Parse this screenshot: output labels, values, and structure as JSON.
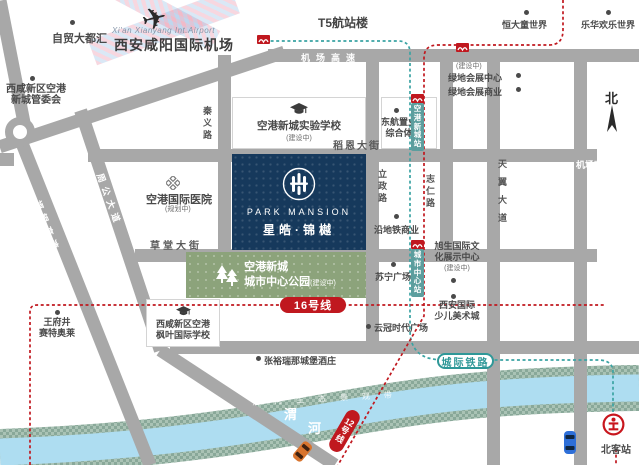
{
  "airport": {
    "cn": "西安咸阳国际机场",
    "en": "Xi'an Xianyang Int.Airport",
    "t5": "T5航站楼"
  },
  "compass": "北",
  "project": {
    "brand": "PARK MANSION",
    "name": "星皓·锦樾"
  },
  "roads": {
    "jichang_h": "机场高速",
    "jichang_v": "机场高速",
    "qinyi": "秦义路",
    "zhougong": "周公大道",
    "fuyin": "福银高速",
    "caotang": "草堂大街",
    "daoen": "稻恩大街",
    "lizheng": "立政路",
    "zhiren": "志仁路",
    "tianyi": "天翼大道"
  },
  "pois": [
    {
      "label": "自贸大都汇"
    },
    {
      "label": "西咸新区空港",
      "label2": "新城管委会"
    },
    {
      "label": "恒大童世界"
    },
    {
      "label": "乐华欢乐世界"
    },
    {
      "label": "绿地会展中心",
      "note": "(建设中)"
    },
    {
      "label": "绿地会展商业"
    },
    {
      "label": "东航置业",
      "label2": "综合体"
    },
    {
      "label": "沿地铁商业"
    },
    {
      "label": "苏宁广场"
    },
    {
      "label": "旭生国际文",
      "label2": "化展示中心",
      "note": "(建设中)"
    },
    {
      "label": "西安国际",
      "label2": "少儿美术城"
    },
    {
      "label": "云冠时代广场"
    },
    {
      "label": "王府井",
      "label2": "赛特奥莱"
    },
    {
      "label": "张裕瑞那城堡酒庄"
    }
  ],
  "hospital": {
    "label": "空港国际医院",
    "note": "(规划中)"
  },
  "school_exp": {
    "label": "空港新城实验学校",
    "note": "(建设中)"
  },
  "school_maple": {
    "label": "西咸新区空港",
    "label2": "枫叶国际学校"
  },
  "park": {
    "label": "空港新城",
    "label2": "城市中心公园",
    "note": "(建设中)"
  },
  "transit": {
    "line16": "16号线",
    "line12": "12号线",
    "intercity": "城际铁路",
    "station1": "空港新城站",
    "station2": "城市中心站",
    "beikezhan": "北客站"
  },
  "river": {
    "char1": "渭",
    "char2": "河",
    "bank_text": "渭河生态景观带"
  },
  "colors": {
    "line_red": "#c0181f",
    "rail_teal": "#3aa3a3",
    "project_navy": "#16395c",
    "park_green": "#8ca37b",
    "river_blue": "#aeddf1",
    "road_gray": "#a8a8a8"
  }
}
